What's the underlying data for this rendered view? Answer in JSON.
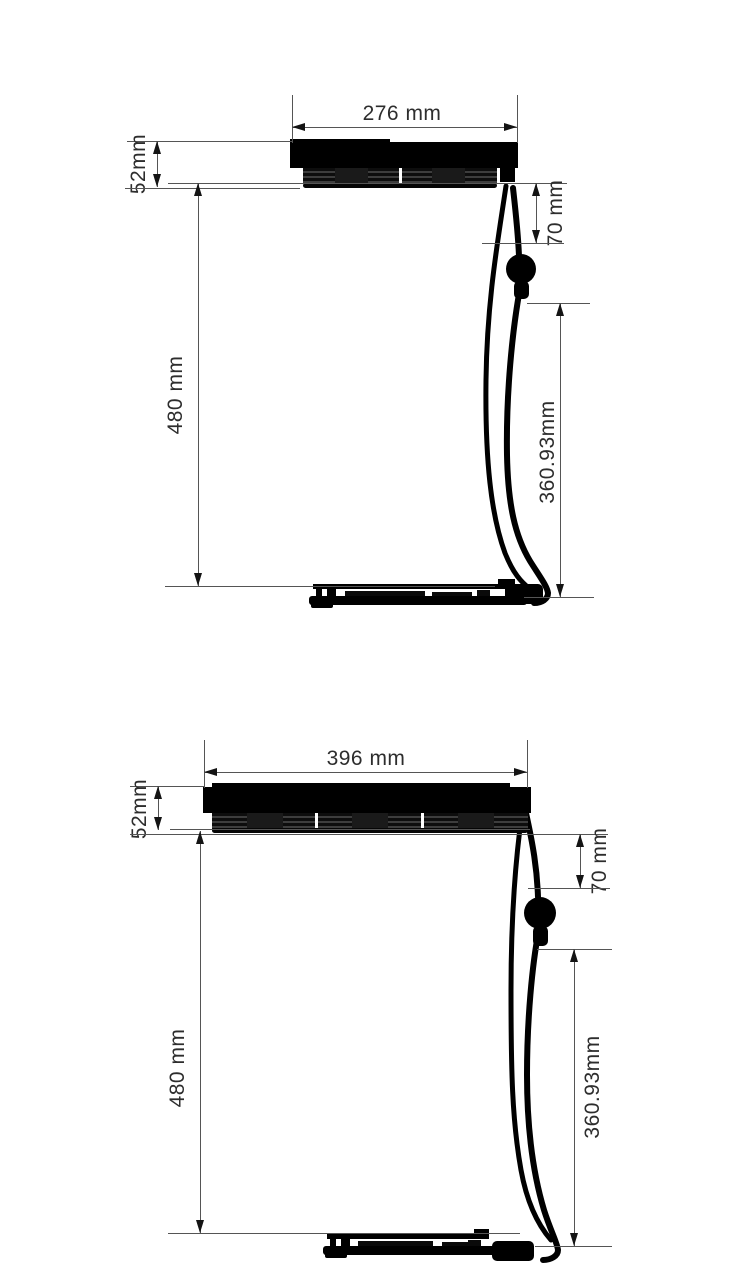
{
  "colors": {
    "background": "#ffffff",
    "line": "#555555",
    "text": "#2d2d2d",
    "fixture": "#000000"
  },
  "diagrams": [
    {
      "name": "light-fixture-two-fans",
      "labels": {
        "width": "276 mm",
        "fixture_height": "52mm",
        "bracket_drop": "70 mm",
        "mount_drop": "480 mm",
        "cable_length": "360.93mm"
      }
    },
    {
      "name": "light-fixture-three-fans",
      "labels": {
        "width": "396 mm",
        "fixture_height": "52mm",
        "bracket_drop": "70 mm",
        "mount_drop": "480 mm",
        "cable_length": "360.93mm"
      }
    }
  ]
}
